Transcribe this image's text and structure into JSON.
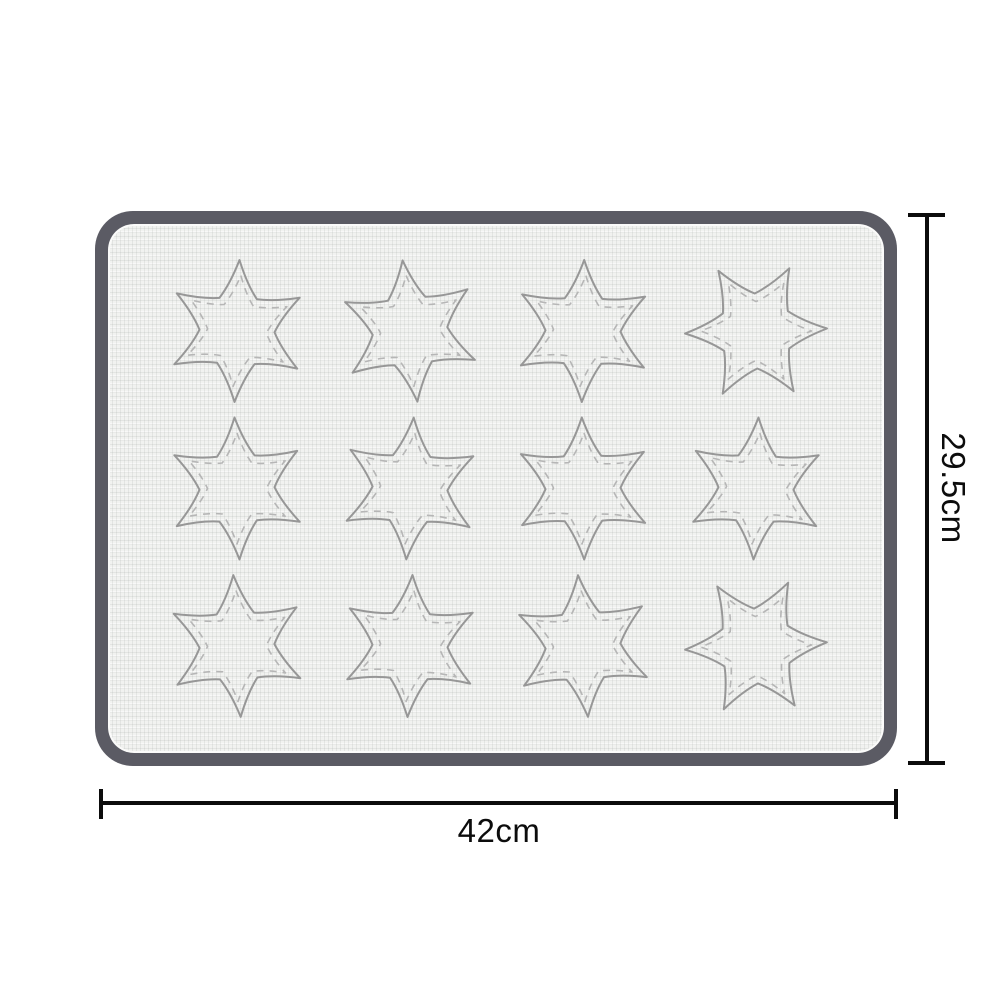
{
  "page": {
    "background_color": "#ffffff",
    "description": "Product dimension diagram of a silicone baking mat with star-shaped macaron templates"
  },
  "product_diagram": {
    "mat": {
      "border_color": "#5b5b64",
      "surface_color": "#f1f2f0",
      "star_rows": 3,
      "star_cols": 4,
      "star_count": 12,
      "star_points": 6,
      "star_outline_color": "#979797",
      "star_inner_outline_color": "#b6b6b6",
      "star_rotations_deg": [
        2,
        -6,
        1,
        28,
        -2,
        3,
        -1,
        2,
        -3,
        2,
        -4,
        27
      ]
    },
    "dimensions": {
      "width_label": "42cm",
      "height_label": "29.5cm",
      "line_color": "#0c0c0c"
    }
  }
}
